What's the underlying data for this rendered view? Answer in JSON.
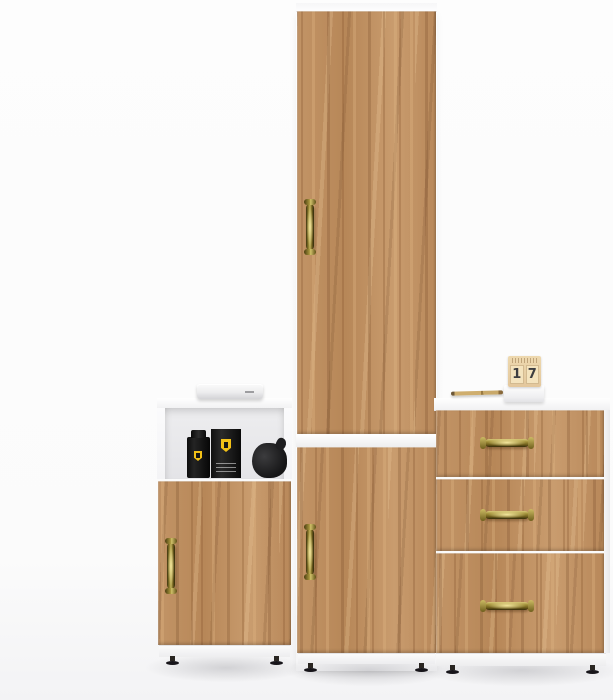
{
  "scene": {
    "type": "furniture product photo",
    "background": "#fbfbfb"
  },
  "palette": {
    "wood_base": "#bd8d5e",
    "wood_dark": "#8a5a33",
    "wood_light": "#d2a878",
    "carcass_white": "#fcfcfc",
    "brass_handle": "#9c8c3a",
    "prop_black": "#161616",
    "ferrari_yellow": "#f2c117"
  },
  "units": {
    "left_cabinet": {
      "label": "low cabinet with open niche and one door"
    },
    "tall_cabinet": {
      "label": "tall two-door wardrobe"
    },
    "drawer_chest": {
      "label": "three-drawer chest"
    }
  },
  "props": {
    "media_device": {
      "label": "white media player"
    },
    "perfume_bottle": {
      "label": "black perfume bottle with yellow shield"
    },
    "perfume_box": {
      "label": "black perfume box with yellow shield"
    },
    "pouch": {
      "label": "black pouch"
    },
    "pen": {
      "label": "gold pen"
    },
    "calendar": {
      "digit_left": "1",
      "digit_right": "7"
    }
  }
}
